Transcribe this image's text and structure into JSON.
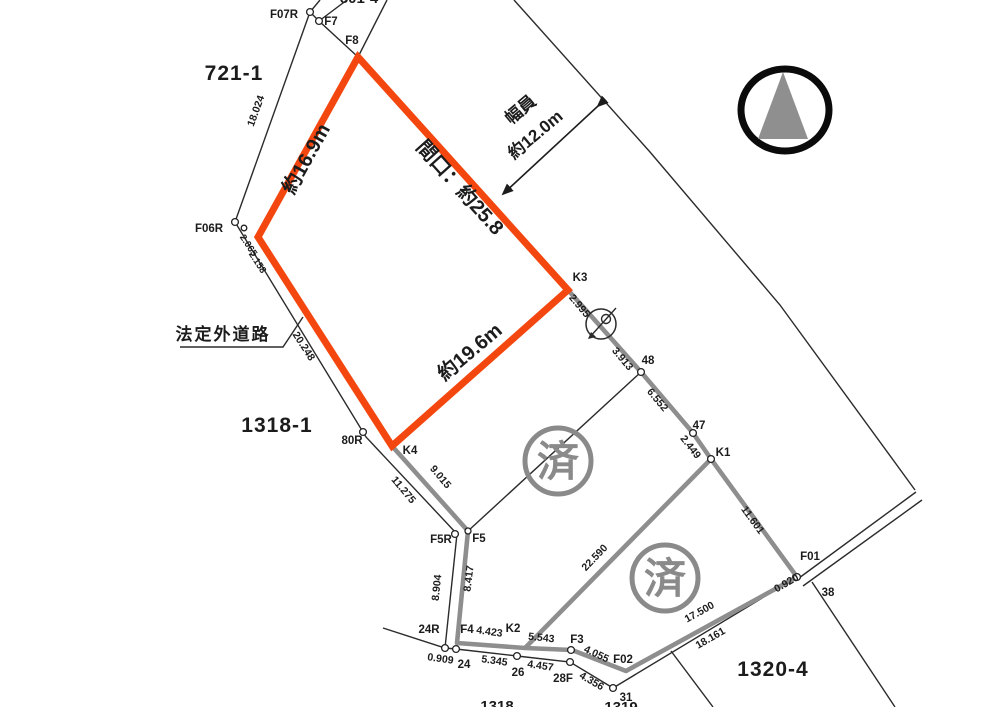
{
  "parcel_labels": {
    "p721_1": "721-1",
    "p1318_1": "1318-1",
    "p1320_4": "1320-4",
    "top_partial": "801-4",
    "bottom_partial_a": "1318",
    "bottom_partial_b": "1319"
  },
  "point_labels": {
    "F07R": "F07R",
    "F7": "F7",
    "F8": "F8",
    "F06R": "F06R",
    "R80": "80R",
    "K4": "K4",
    "K3": "K3",
    "P48": "48",
    "P47": "47",
    "K1": "K1",
    "F5R": "F5R",
    "F5": "F5",
    "R24": "24R",
    "F4": "F4",
    "K2": "K2",
    "F3": "F3",
    "F02": "F02",
    "P24": "24",
    "P26": "26",
    "P28F": "28F",
    "P31": "31",
    "F01": "F01",
    "P38": "38"
  },
  "measurements": {
    "m_18_024": "18.024",
    "m_2_065": "2.065",
    "m_2_158": "2.158",
    "m_20_248": "20.248",
    "m_11_275": "11.275",
    "m_9_015": "9.015",
    "m_8_904": "8.904",
    "m_8_417": "8.417",
    "m_0_909": "0.909",
    "m_5_345": "5.345",
    "m_4_457": "4.457",
    "m_4_423": "4.423",
    "m_5_543": "5.543",
    "m_4_055": "4.055",
    "m_4_356": "4.356",
    "m_2_995": "2.995",
    "m_3_913": "3.913",
    "m_6_552": "6.552",
    "m_2_449": "2.449",
    "m_11_601": "11.601",
    "m_22_590": "22.590",
    "m_17_500": "17.500",
    "m_18_161": "18.161",
    "m_0_920": "0.920"
  },
  "dimension_notes": {
    "width_label": "幅員",
    "width_value": "約12.0m",
    "frontage": "間口：約25.8",
    "side_left": "約16.9m",
    "side_bottom": "約19.6m"
  },
  "annotations": {
    "road": "法定外道路",
    "stamp": "済"
  },
  "colors": {
    "highlight": "#F4470F",
    "survey_gray": "#8E8E8E",
    "line": "#2B2B2B",
    "stamp_gray": "#8A8A8A"
  }
}
